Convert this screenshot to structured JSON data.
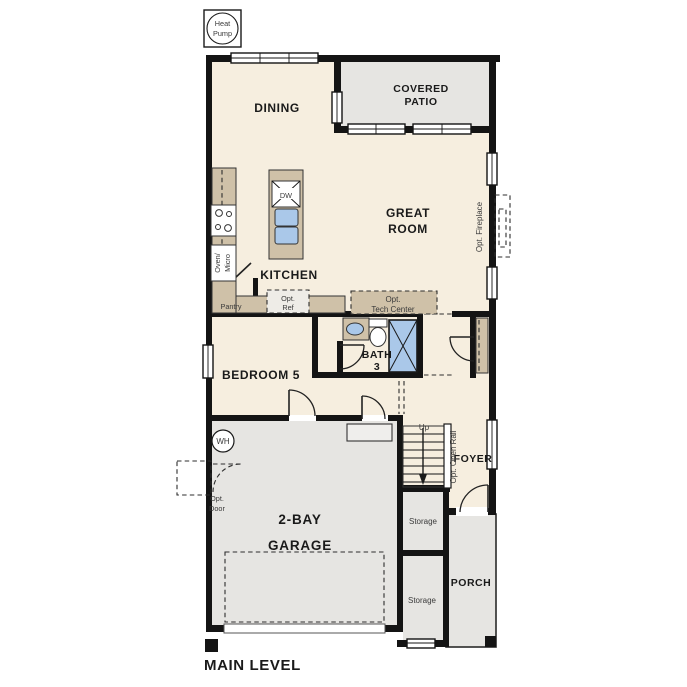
{
  "colors": {
    "floor": "#f6eedf",
    "hard_surface": "#e6e5e2",
    "counter": "#cfc1a8",
    "fixture_blue": "#aac8e9",
    "wall": "#141414"
  },
  "legend": {
    "heat": "Heat",
    "pump": "Pump"
  },
  "rooms": {
    "dining": "DINING",
    "covered_patio1": "COVERED",
    "covered_patio2": "PATIO",
    "great_room1": "GREAT",
    "great_room2": "ROOM",
    "kitchen": "KITCHEN",
    "bedroom5": "BEDROOM 5",
    "bath1": "BATH",
    "bath2": "3",
    "foyer": "FOYER",
    "garage1": "2-BAY",
    "garage2": "GARAGE",
    "porch": "PORCH",
    "storage_upper": "Storage",
    "storage_lower": "Storage"
  },
  "annotations": {
    "pantry": "Pantry",
    "opt_ref1": "Opt.",
    "opt_ref2": "Ref",
    "opt_tech1": "Opt.",
    "opt_tech2": "Tech Center",
    "opt_fireplace": "Opt. Fireplace",
    "opt_open_rail": "Opt. Open Rail",
    "opt_door1": "Opt.",
    "opt_door2": "Door",
    "up": "Up",
    "dw": "DW",
    "oven_micro1": "Oven/",
    "oven_micro2": "Micro",
    "wh": "WH"
  },
  "footer": {
    "main_level": "MAIN LEVEL"
  }
}
